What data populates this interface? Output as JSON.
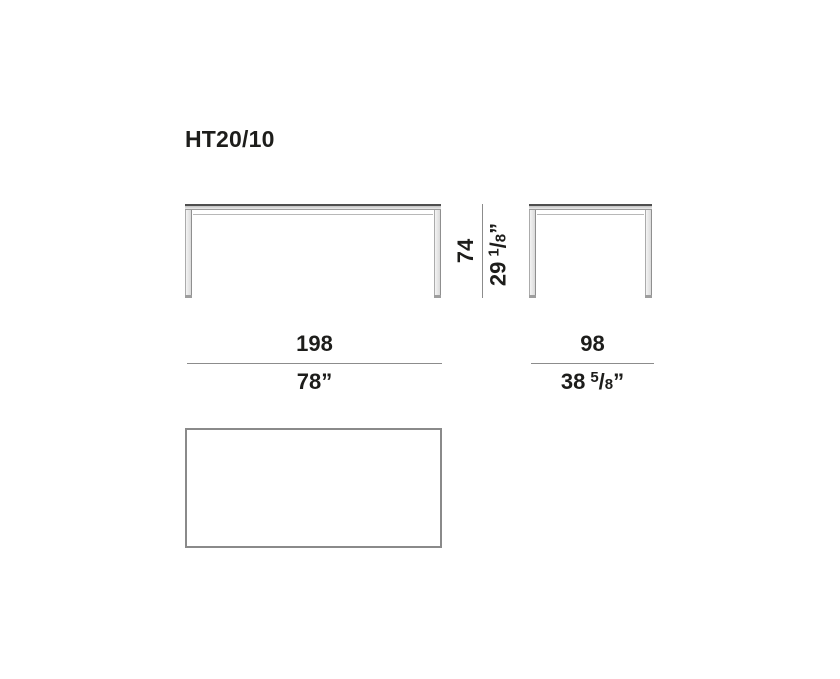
{
  "title": "HT20/10",
  "dimensions": {
    "height": {
      "cm": "74",
      "in_whole": "29",
      "in_num": "1",
      "in_slash": "/",
      "in_den": "8",
      "in_mark": "”"
    },
    "width": {
      "cm": "198",
      "in_whole": "78",
      "in_num": "",
      "in_slash": "",
      "in_den": "",
      "in_mark": "”"
    },
    "depth": {
      "cm": "98",
      "in_whole": "38",
      "in_num": "5",
      "in_slash": "/",
      "in_den": "8",
      "in_mark": "”"
    }
  },
  "colors": {
    "ink": "#1d1d1b",
    "dimension_line": "#8c8c8c",
    "outline_dark": "#4f4f4f",
    "fill_light": "#ededed",
    "background": "#ffffff"
  }
}
